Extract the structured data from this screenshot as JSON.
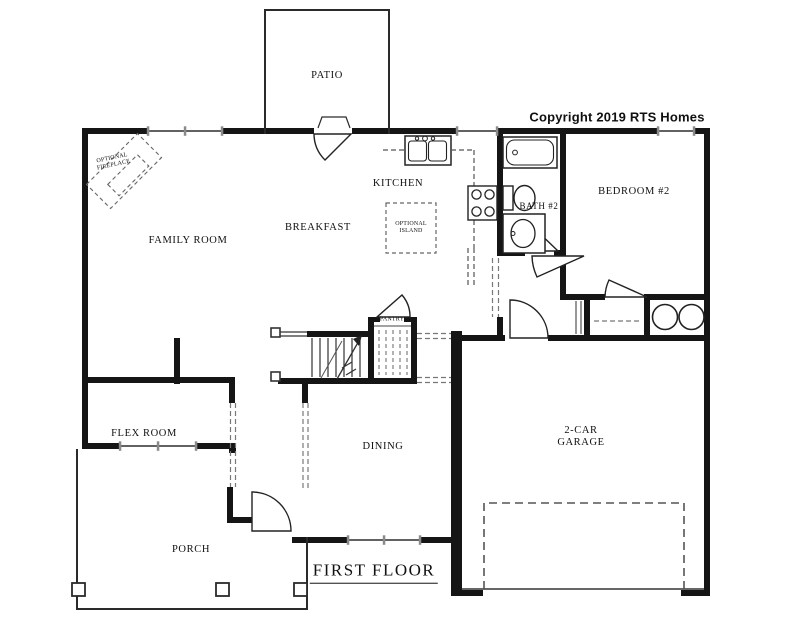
{
  "plan": {
    "copyright": "Copyright 2019 RTS Homes",
    "title": "FIRST FLOOR",
    "rooms": {
      "patio": "PATIO",
      "family_room": "FAMILY ROOM",
      "breakfast": "BREAKFAST",
      "kitchen": "KITCHEN",
      "bath2": "BATH #2",
      "bedroom2": "BEDROOM #2",
      "pantry": "PANTRY",
      "flex_room": "FLEX ROOM",
      "dining": "DINING",
      "garage": "2-CAR GARAGE",
      "porch": "PORCH"
    },
    "annotations": {
      "optional_fireplace": "OPTIONAL FIREPLACE",
      "optional_island": "OPTIONAL ISLAND"
    },
    "symbols": [
      "stairs-up-arrow",
      "washer",
      "dryer",
      "tub",
      "toilet",
      "vanity-sink",
      "kitchen-sink",
      "range",
      "garage-door",
      "porch-columns",
      "door-swings"
    ],
    "colors": {
      "background": "#ffffff",
      "wall": "#151515",
      "line": "#2e2e2e",
      "dashed": "#666666",
      "text": "#101010"
    }
  }
}
